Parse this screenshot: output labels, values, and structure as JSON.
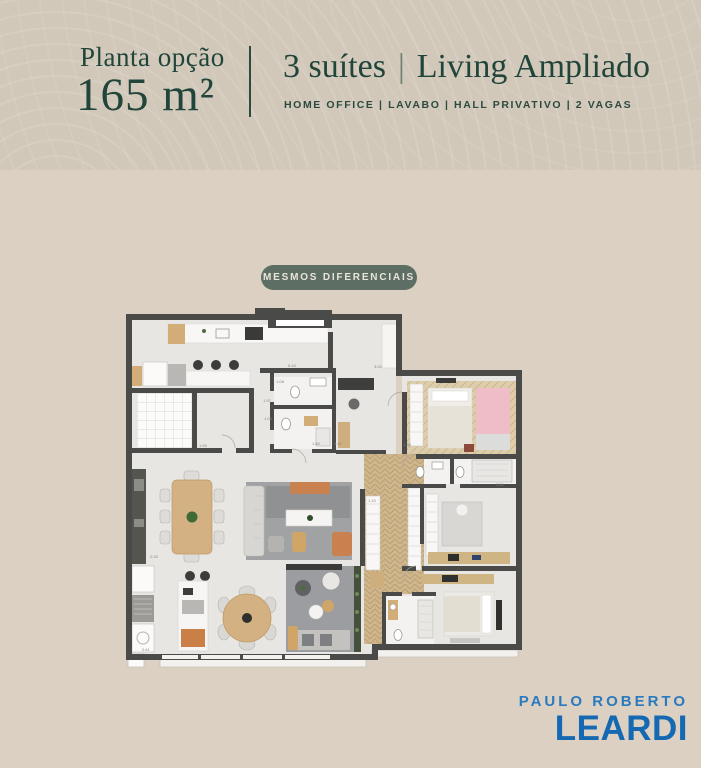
{
  "page": {
    "background": "#dbd0c2",
    "header_background": "#d2c8ba"
  },
  "header": {
    "plan_label": "Planta opção",
    "area_value": "165 m²",
    "suites": "3 suítes",
    "separator": "|",
    "living": "Living Ampliado",
    "features": "HOME OFFICE | LAVABO | HALL PRIVATIVO | 2 VAGAS",
    "text_color": "#21453a"
  },
  "badge": {
    "label": "MESMOS DIFERENCIAIS",
    "background": "#5d6f64",
    "text_color": "#eae4d6"
  },
  "floorplan": {
    "wall_color": "#4a4a48",
    "floor_color": "#e7e6e3",
    "wood_color": "#d0b68c",
    "accent_orange": "#c9824f",
    "accent_pink": "#eebdc7",
    "plant_green": "#4e6b3e",
    "dims": [
      {
        "t": "6.10"
      },
      {
        "t": "3.02"
      },
      {
        "t": "1.08"
      },
      {
        "t": "1.97"
      },
      {
        "t": "1.09"
      },
      {
        "t": "1.80"
      },
      {
        "t": "1.51"
      },
      {
        "t": "1.90"
      },
      {
        "t": "0.33"
      },
      {
        "t": "0.41"
      },
      {
        "t": "1.10"
      },
      {
        "t": "2.20"
      },
      {
        "t": "1.36"
      }
    ]
  },
  "brand": {
    "line1": "PAULO ROBERTO",
    "line2": "LEARDI",
    "line1_color": "#2a7abf",
    "line2_color": "#1568b2"
  }
}
